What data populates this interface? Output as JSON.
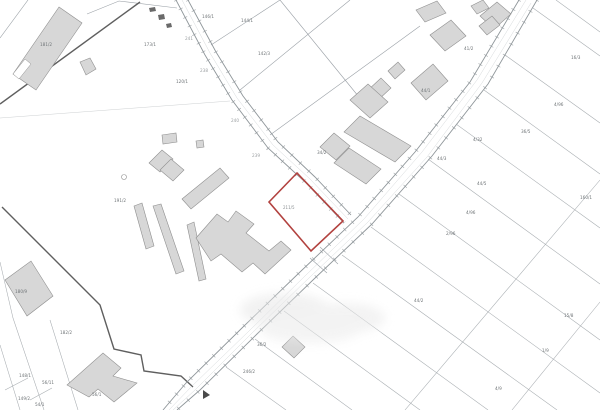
{
  "map": {
    "kind": "cadastral-parcel-map",
    "colors": {
      "background": "#ffffff",
      "parcel_line": "#9aa0a6",
      "boundary_dark": "#5f5f5f",
      "building_fill": "#d7d7d7",
      "building_stroke": "#8f8f8f",
      "highlight_outline": "#b2423f",
      "label_text": "#6f7477"
    },
    "highlight_parcel": {
      "label": "211/5",
      "outline_color": "#b2423f"
    },
    "parcel_labels": [
      "181/2",
      "173/1",
      "146/1",
      "144/1",
      "142/3",
      "120/1",
      "241",
      "238",
      "240",
      "239",
      "34/2",
      "191/2",
      "44/1",
      "4/32",
      "44/3",
      "41/2",
      "16/3",
      "4/96",
      "36/5",
      "44/5",
      "160/1",
      "4/96",
      "2/96",
      "15/8",
      "1/9",
      "4/9",
      "44/2",
      "246/2",
      "36/2",
      "180/9",
      "182/2",
      "56/11",
      "56/1",
      "149/2",
      "54/1",
      "148/1"
    ]
  }
}
